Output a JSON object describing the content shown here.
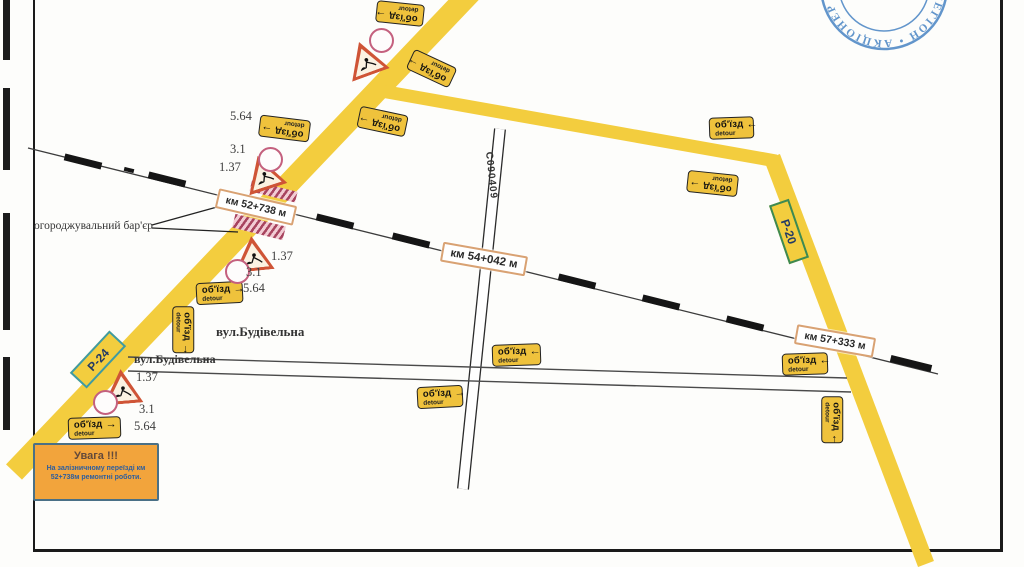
{
  "stamp": {
    "ring_text": "АКЦІОНЕР • РЕГІОН • АКЦІОНЕР • РЕГІОН • Я",
    "color": "#3c7cc0"
  },
  "signs": {
    "text": "об'їзд",
    "sub": "detour",
    "arrow_right": "→",
    "arrow_left": "←",
    "arrow_up": "↑",
    "arrow_down": "↓"
  },
  "km_markers": [
    {
      "text": "км 52+738 м"
    },
    {
      "text": "км 54+042 м"
    },
    {
      "text": "км 57+333 м"
    }
  ],
  "road_shields": {
    "p24": "Р-24",
    "p20": "Р-20",
    "c_road": "С090409"
  },
  "street_labels": [
    {
      "text": "вул.Будівельна"
    },
    {
      "text": "вул.Будівельна"
    }
  ],
  "barrier_label": {
    "text": "огороджувальний бар'єр"
  },
  "ref_numbers": [
    {
      "t": "5.64"
    },
    {
      "t": "3.1"
    },
    {
      "t": "1.37"
    },
    {
      "t": "1.37"
    },
    {
      "t": "3.1"
    },
    {
      "t": "5.64"
    },
    {
      "t": "1.37"
    },
    {
      "t": "3.1"
    },
    {
      "t": "5.64"
    }
  ],
  "warning_box": {
    "title": "Увага !!!",
    "line1": "На залізничному переїзді км",
    "line2": "52+738м ремонтні роботи."
  },
  "colors": {
    "road_yellow": "#f3cd3e",
    "sign_yellow": "#efc23c",
    "km_border_tan": "#d9a273",
    "hatch_red": "#a8445f",
    "p24_border_teal": "#3e9ba3",
    "p20_border_green": "#3d8a52",
    "warn_border_blue": "#4a7086",
    "stamp_blue": "#3c7cc0"
  }
}
